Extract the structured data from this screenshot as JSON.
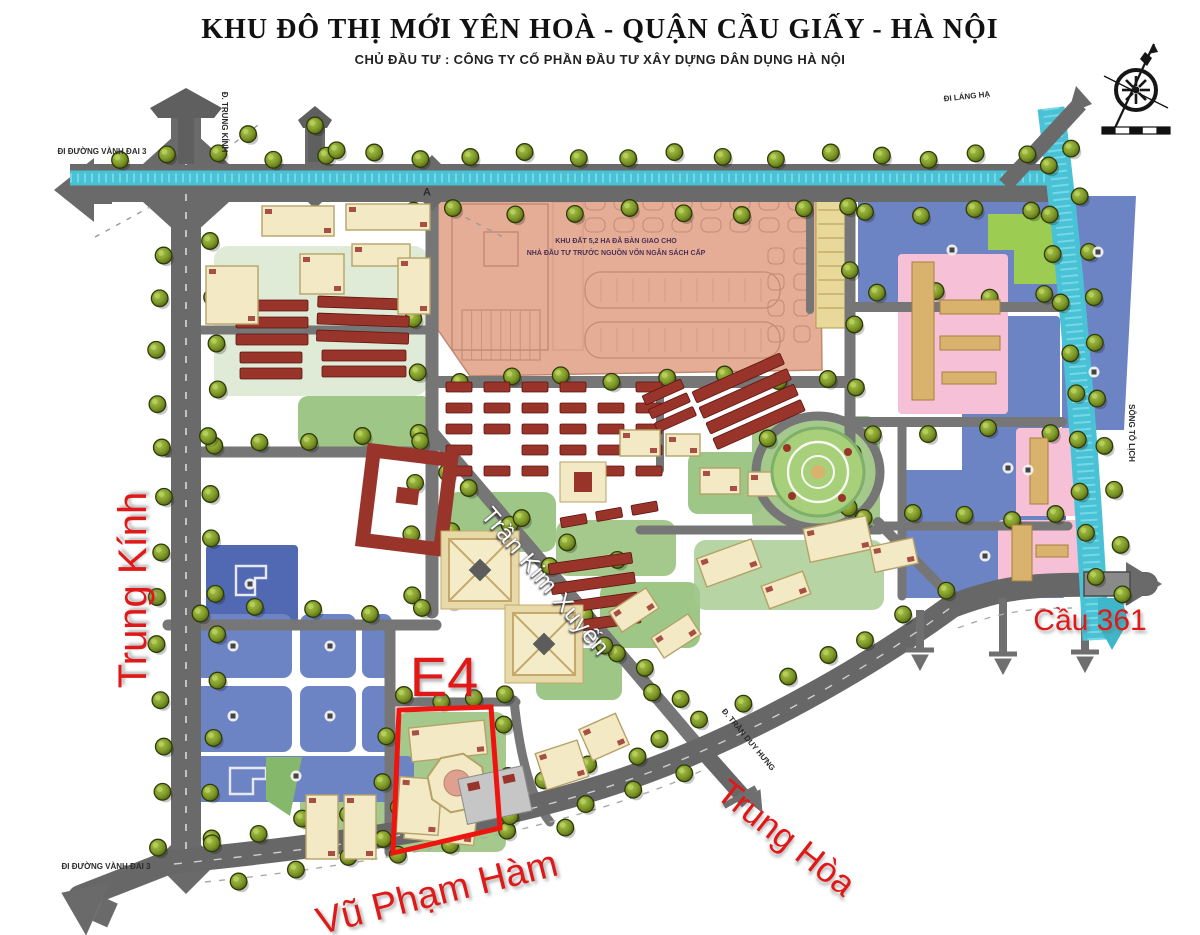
{
  "header": {
    "title": "KHU ĐÔ THỊ MỚI YÊN HOÀ - QUẬN CẦU GIẤY - HÀ NỘI",
    "subtitle": "CHỦ ĐẦU TƯ : CÔNG TY CỔ PHẦN ĐẦU TƯ XÂY DỰNG DÂN DỤNG HÀ NỘI"
  },
  "annotations": {
    "trung_kinh": "Trung Kính",
    "e4": "E4",
    "vu_pham_ham": "Vũ Phạm Hàm",
    "trung_hoa": "Trung Hòa",
    "cau_361": "Cầu 361",
    "tran_kim_xuyen": "Trần Kim Xuyến"
  },
  "road_labels": {
    "vanh_dai_3": "ĐI ĐƯỜNG VÀNH ĐAI 3",
    "di_lang_ha": "ĐI LÁNG HẠ",
    "tran_duy_hung": "Đ. TRẦN DUY HƯNG",
    "song_to_lich": "SÔNG TÔ LỊCH",
    "trung_kinh_vertical": "Đ. TRUNG KÍNH",
    "marker_a": "A"
  },
  "salmon_block_note": {
    "line1": "KHU ĐẤT 5,2 HA ĐÃ BÀN GIAO CHO",
    "line2": "NHÀ ĐẦU TƯ TRƯỚC NGUỒN VỐN NGÂN SÁCH CẤP"
  },
  "palette": {
    "annotation_red": "#e11818",
    "highlight_box_red": "#ee1410",
    "road_gray": "#6a6a6a",
    "minor_road_gray": "#767676",
    "river_teal": "#49c2d6",
    "river_light": "#8fe3ef",
    "parcel_blue": "#6d84c4",
    "parcel_blue_dark": "#5168b2",
    "parcel_pink": "#f6c0d6",
    "parcel_salmon": "#e5ad96",
    "parcel_green": "#9ccc52",
    "lawn_green": "#85b86a",
    "building_cream": "#f3e9c4",
    "building_cream_edge": "#b5a268",
    "building_red": "#99342b",
    "building_tan": "#d9b26e",
    "tree_green": "#7f9a28",
    "tree_dark": "#2f3a08"
  }
}
